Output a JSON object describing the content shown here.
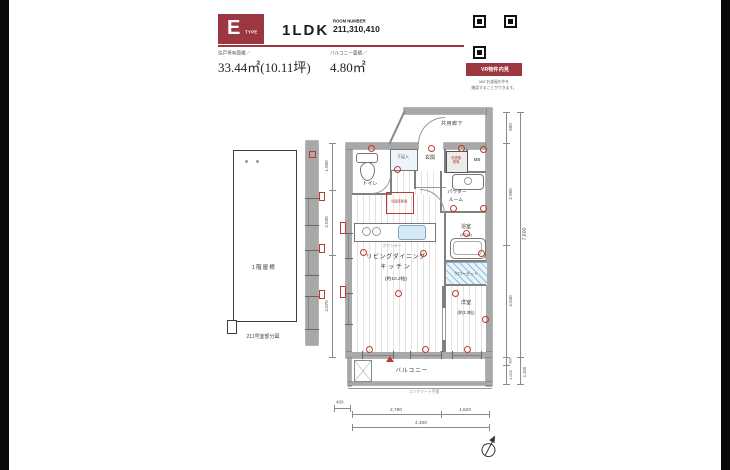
{
  "colors": {
    "accent": "#9c3641"
  },
  "header": {
    "type_letter": "E",
    "type_word": "TYPE",
    "layout": "1LDK",
    "room_number_label": "ROOM NUMBER",
    "room_number_value": "211,310,410",
    "exclusive_area_label": "住戸専有面積／",
    "exclusive_area_value": "33.44㎡(10.11坪)",
    "balcony_area_label": "バルコニー面積／",
    "balcony_area_value": "4.80㎡"
  },
  "vr": {
    "button_label": "VR物件内見",
    "caption_line1": "360°お部屋の中を",
    "caption_line2": "確認することができます。"
  },
  "partial_diagram": {
    "roof_label": "1階屋根",
    "caption": "211号室部分図"
  },
  "floorplan": {
    "rooms": {
      "corridor": "共用廊下",
      "entrance": "玄関",
      "shoe_box": "下足入",
      "toilet": "トイレ",
      "washer": "洗濯機置場",
      "meter_box": "MB",
      "powder_line1": "パウダー",
      "powder_line2": "ルーム",
      "bath": "浴室",
      "bath_size": "(1216)",
      "closet": "クローゼット",
      "ldk_line1": "リビングダイニング",
      "ldk_line2": "キッチン",
      "ldk_size": "(約10.2帖)",
      "bedroom": "洋室",
      "bedroom_size": "(約3.3帖)",
      "balcony": "バルコニー",
      "fridge": "冷蔵庫置場",
      "counter": "カウンター",
      "handrail": "コンクリート手摺"
    },
    "dims": {
      "right": [
        "600",
        "2,960",
        "4,040"
      ],
      "right_total": "7,600",
      "balcony_right": [
        "300",
        "1,000"
      ],
      "balcony_right_total": "1,300",
      "left": [
        "1,500",
        "2,030",
        "4,070"
      ],
      "bottom": [
        "2,780",
        "1,620"
      ],
      "bottom_total": "4,400",
      "bottom_small": "400"
    }
  }
}
